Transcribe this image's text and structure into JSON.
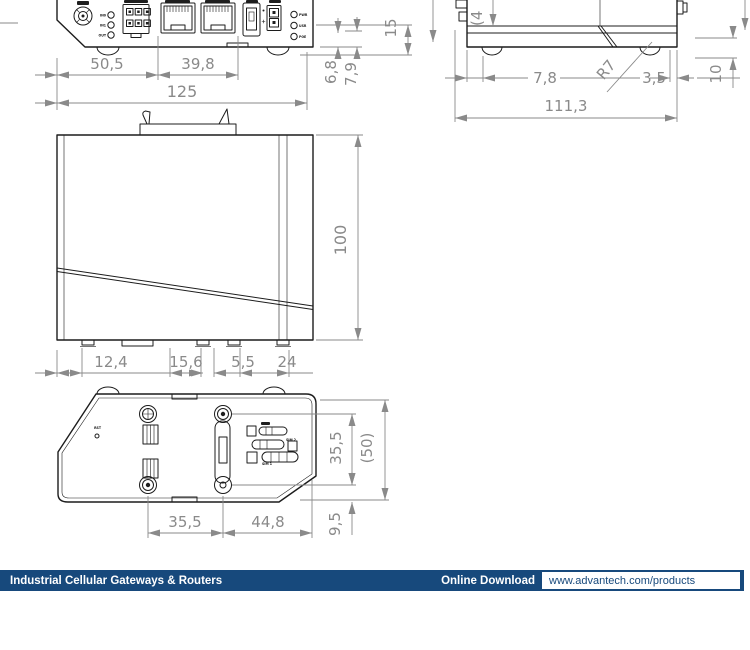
{
  "footer": {
    "category_label": "Industrial Cellular Gateways & Routers",
    "download_label": "Online Download",
    "download_url": "www.advantech.com/products"
  },
  "colors": {
    "footer_bar": "#17497c",
    "drawing_line": "#1c1c1c",
    "dimension_gray": "#8a8a8a"
  },
  "views": {
    "front": {
      "io_labels": [
        "IN0",
        "IN1",
        "OUT"
      ],
      "led_labels": [
        "PWR",
        "USR",
        "POE"
      ],
      "dims": {
        "w1": "50,5",
        "w2": "39,8",
        "w_total": "125",
        "h1": "6,8",
        "h2": "7,9",
        "h3": "15"
      }
    },
    "side": {
      "dims": {
        "partial": "(4",
        "foot_offset": "7,8",
        "radius": "R7",
        "edge": "3,5",
        "height": "10",
        "length": "111,3"
      }
    },
    "top": {
      "dims": {
        "depth": "100",
        "f1": "12,4",
        "f2": "15,6",
        "f3": "5,5",
        "f4": "24"
      }
    },
    "bottom": {
      "reset_label": "RST",
      "sim_labels": [
        "SIM 2",
        "SIM 1"
      ],
      "dims": {
        "hole_v": "35,5",
        "overall": "(50)",
        "hole_h": "35,5",
        "hole_h2": "44,8",
        "offset": "9,5"
      }
    }
  }
}
